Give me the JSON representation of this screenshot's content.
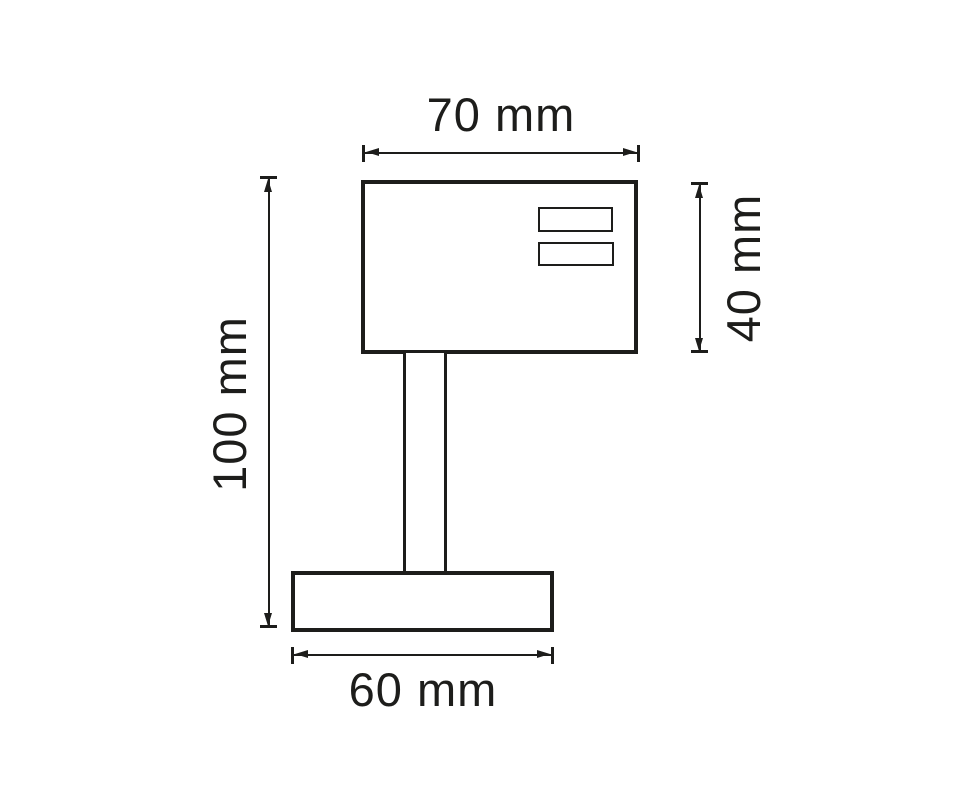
{
  "diagram": {
    "colors": {
      "line": "#1d1d1b",
      "background": "#ffffff"
    },
    "dimensions": {
      "top_width": "70 mm",
      "right_height": "40 mm",
      "left_height": "100 mm",
      "bottom_width": "60 mm"
    }
  }
}
